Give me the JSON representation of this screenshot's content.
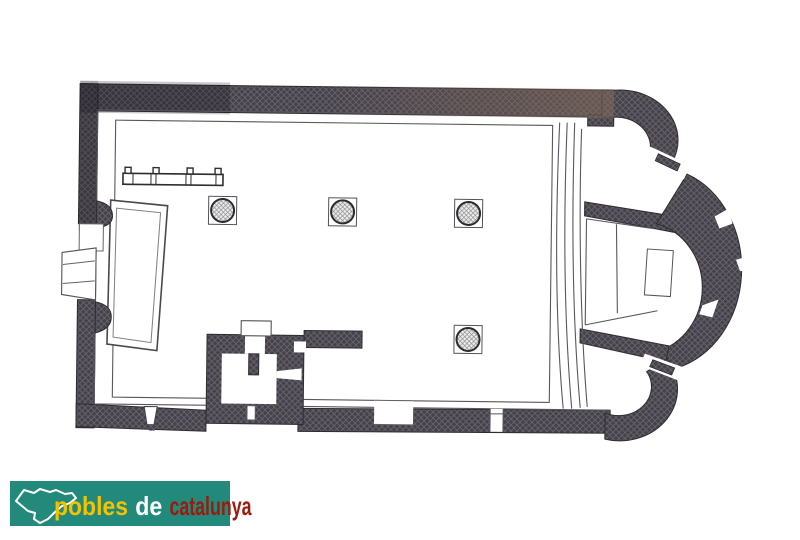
{
  "page": {
    "background_color": "#ffffff"
  },
  "logo": {
    "bg_color": "#23897B",
    "parts": [
      {
        "text": "pobles",
        "color": "#F3C300"
      },
      {
        "text": "de",
        "color": "#FFFFFF"
      },
      {
        "text": "catalunya",
        "color": "#9A1B0D"
      }
    ]
  },
  "floor_plan": {
    "type": "church floor plan (scanned line drawing)",
    "wall_fill": "#454149",
    "wall_hatch": "#6A6570",
    "wall_tint_right": "#7A6354",
    "thin_line_color": "#5A565E",
    "column_fill": "#EDEDED",
    "apse_count": 3,
    "column_count": 4,
    "columns": [
      {
        "cx": 222,
        "cy": 212
      },
      {
        "cx": 342,
        "cy": 212
      },
      {
        "cx": 468,
        "cy": 212
      },
      {
        "cx": 469,
        "cy": 338
      }
    ],
    "features": [
      "nave",
      "west-portal",
      "wall-niche",
      "side-chapel",
      "communion-rail",
      "bell-tower-base",
      "south-doorways",
      "chancel-steps",
      "presbytery-platform",
      "altar",
      "central-apse",
      "north-apsidiole",
      "south-apsidiole",
      "splayed-windows"
    ]
  }
}
